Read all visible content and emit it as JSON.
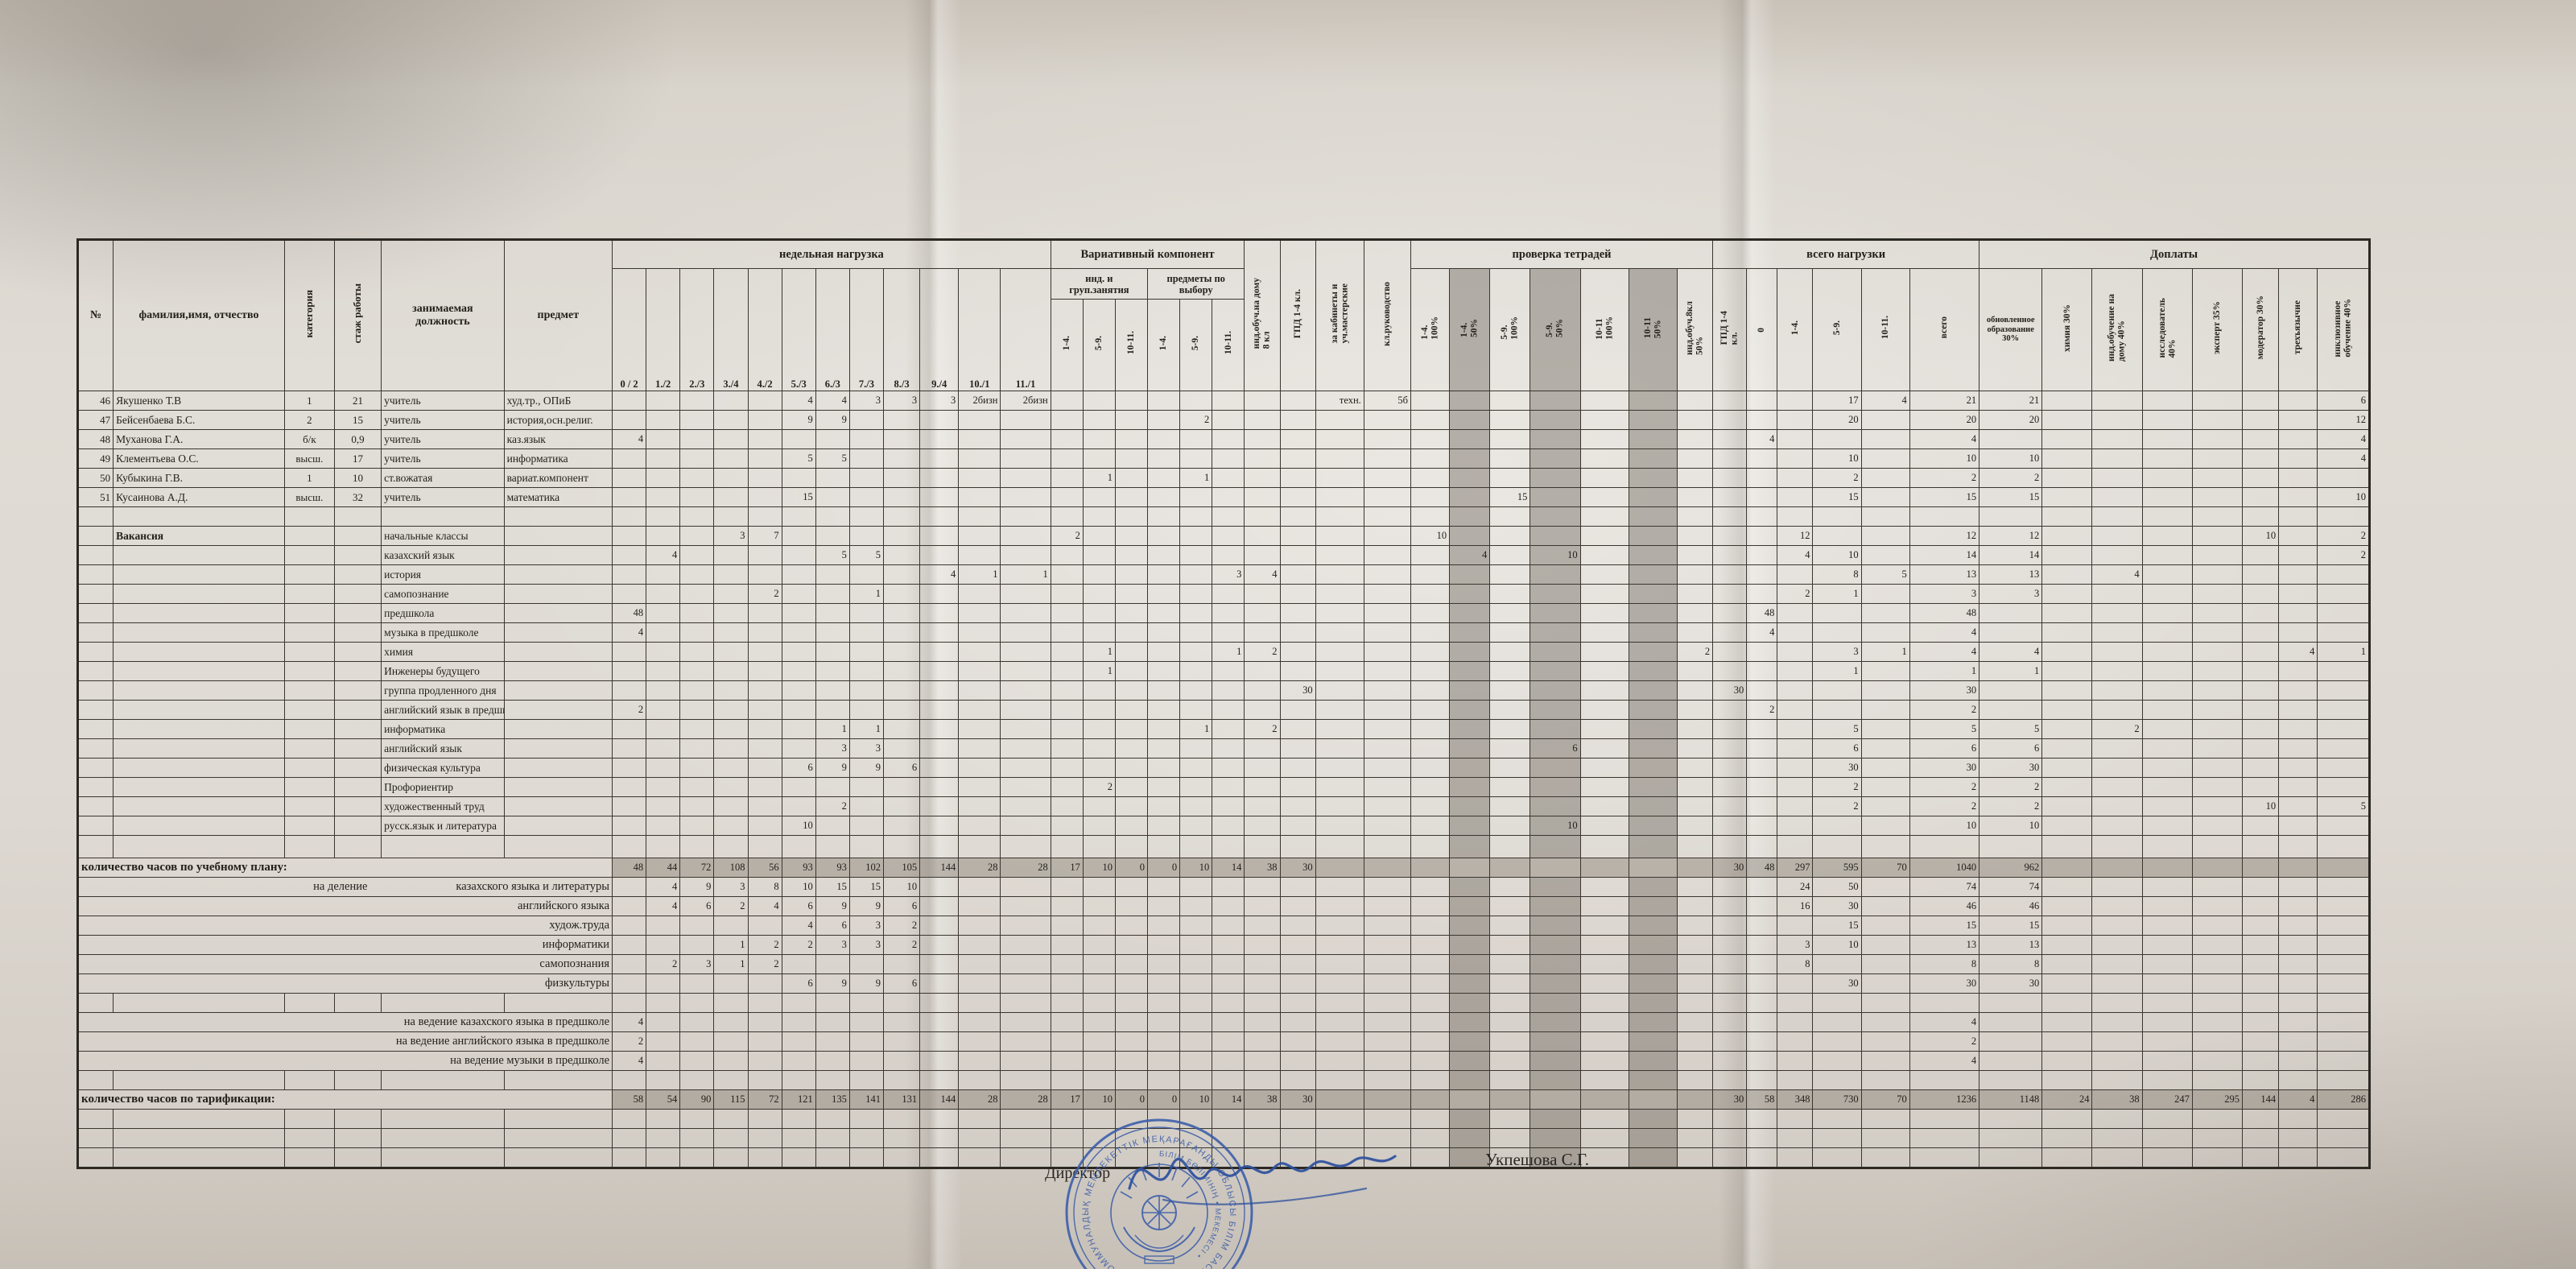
{
  "footer": {
    "director_label": "Директор",
    "director_name": "Укпешова С.Г.",
    "stamp_ring_text": "ҚАРАҒАНДЫ ОБЛЫСЫ БІЛІМ БАСҚАРМАСЫНЫҢ • КОММУНАЛДЫҚ МЕМЛЕКЕТТІК МЕКЕМЕСІ •",
    "stamp_inner_text": "БІЛІМ БӨЛІМІНІҢ • МЕКЕМЕСІ •"
  },
  "table": {
    "base_headers": [
      {
        "label": "№"
      },
      {
        "label": "фамилия,имя, отчество"
      },
      {
        "label": "категория",
        "rotate": true
      },
      {
        "label": "стаж работы",
        "rotate": true
      },
      {
        "label": "занимаемая должность"
      },
      {
        "label": "предмет"
      }
    ],
    "groups": {
      "weekly": "недельная нагрузка",
      "variativ": "Вариативный компонент",
      "notebooks": "проверка тетрадей",
      "load": "всего нагрузки",
      "bonus": "Доплаты"
    },
    "weekly_cols": [
      "0 / 2",
      "1./2",
      "2./3",
      "3./4",
      "4./2",
      "5./3",
      "6./3",
      "7./3",
      "8./3",
      "9./4",
      "10./1",
      "11./1"
    ],
    "variativ_groups": [
      "инд. и\nгруп.занятия",
      "предметы по\nвыбору"
    ],
    "variativ_cols": [
      "1-4.",
      "5-9.",
      "10-11.",
      "1-4.",
      "5-9.",
      "10-11."
    ],
    "single_cols": [
      "инд.обуч.на дому\n8 кл",
      "ГПД    1-4 кл.",
      "за кабинеты и\nуч.мастерские",
      "кл.руководство"
    ],
    "notebook_cols": [
      "1-4.\n100%",
      "1-4.\n50%",
      "5-9.\n100%",
      "5-9.\n50%",
      "10-11\n100%",
      "10-11\n50%",
      "инд.обуч.8кл\n50%"
    ],
    "load_cols": [
      "ГПД 1-4\nкл.",
      "0",
      "1-4.",
      "5-9.",
      "10-11.",
      "всего"
    ],
    "bonus_cols": [
      "обновленное\nобразование\n30%",
      "химия 30%",
      "инд.обучение на\nдому 40%",
      "исследователь\n40%",
      "эксперт 35%",
      "модератор 30%",
      "трехъязычие",
      "инклюзивное\nобучение 40%"
    ],
    "rows": [
      {
        "type": "staff",
        "num": "46",
        "name": "Якушенко Т.В",
        "cat": "1",
        "exp": "21",
        "pos": "учитель",
        "subj": "худ.тр., ОПиБ",
        "cells": {
          "g5": "4",
          "g6": "4",
          "g7": "3",
          "g8": "3",
          "g9": "3",
          "g10": "2бизн",
          "g11": "2бизн",
          "cab": "техн.",
          "lead": "5б",
          "t59": "17",
          "t1011": "4",
          "tot": "21",
          "ren": "21",
          "inc": "6"
        }
      },
      {
        "type": "staff",
        "num": "47",
        "name": "Бейсенбаева Б.С.",
        "cat": "2",
        "exp": "15",
        "pos": "учитель",
        "subj": "история,осн.религ.",
        "cells": {
          "g5": "9",
          "g6": "9",
          "pv59": "2",
          "t59": "20",
          "tot": "20",
          "ren": "20",
          "inc": "12"
        }
      },
      {
        "type": "staff",
        "num": "48",
        "name": "Муханова Г.А.",
        "cat": "б/к",
        "exp": "0,9",
        "pos": "учитель",
        "subj": "каз.язык",
        "cells": {
          "g0": "4",
          "t0": "4",
          "tot": "4",
          "inc": "4"
        }
      },
      {
        "type": "staff",
        "num": "49",
        "name": "Клементьева О.С.",
        "cat": "высш.",
        "exp": "17",
        "pos": "учитель",
        "subj": "информатика",
        "cells": {
          "g5": "5",
          "g6": "5",
          "t59": "10",
          "tot": "10",
          "ren": "10",
          "inc": "4"
        }
      },
      {
        "type": "staff",
        "num": "50",
        "name": "Кубыкина Г.В.",
        "cat": "1",
        "exp": "10",
        "pos": "ст.вожатая",
        "subj": "вариат.компонент",
        "cells": {
          "ig59": "1",
          "pv59": "1",
          "t59": "2",
          "tot": "2",
          "ren": "2"
        }
      },
      {
        "type": "staff",
        "num": "51",
        "name": "Кусаинова А.Д.",
        "cat": "высш.",
        "exp": "32",
        "pos": "учитель",
        "subj": "математика",
        "cells": {
          "g5": "15",
          "n59a": "15",
          "t59": "15",
          "tot": "15",
          "ren": "15",
          "inc": "10"
        }
      },
      {
        "type": "spacer",
        "h": 12
      },
      {
        "type": "vacancy",
        "name": "Вакансия",
        "pos": "начальные классы",
        "cells": {
          "g3": "3",
          "g4": "7",
          "ig14": "2",
          "n14a": "10",
          "t14": "12",
          "tot": "12",
          "ren": "12",
          "mod": "10",
          "inc": "2"
        }
      },
      {
        "type": "vacancy",
        "name": "",
        "pos": "казахский язык",
        "cells": {
          "g1": "4",
          "g6": "5",
          "g7": "5",
          "n14b": "4",
          "n59b": "10",
          "t14": "4",
          "t59": "10",
          "tot": "14",
          "ren": "14",
          "inc": "2"
        }
      },
      {
        "type": "vacancy",
        "name": "",
        "pos": "история",
        "cells": {
          "g9": "4",
          "g10": "1",
          "g11": "1",
          "pv1011": "3",
          "home": "4",
          "t59": "8",
          "t1011": "5",
          "tot": "13",
          "ren": "13",
          "dhome": "4"
        }
      },
      {
        "type": "vacancy",
        "name": "",
        "pos": "самопознание",
        "cells": {
          "g4": "2",
          "g7": "1",
          "t14": "2",
          "t59": "1",
          "tot": "3",
          "ren": "3"
        }
      },
      {
        "type": "vacancy",
        "name": "",
        "pos": "предшкола",
        "cells": {
          "g0": "48",
          "t0": "48",
          "tot": "48"
        }
      },
      {
        "type": "vacancy",
        "name": "",
        "pos": "музыка в предшколе",
        "cells": {
          "g0": "4",
          "t0": "4",
          "tot": "4"
        }
      },
      {
        "type": "vacancy",
        "name": "",
        "pos": "химия",
        "cells": {
          "ig59": "1",
          "pv1011": "1",
          "home": "2",
          "nind": "2",
          "t59": "3",
          "t1011": "1",
          "tot": "4",
          "ren": "4",
          "tri": "4",
          "inc": "1"
        }
      },
      {
        "type": "vacancy",
        "name": "",
        "pos": "Инженеры будущего",
        "cells": {
          "ig59": "1",
          "t59": "1",
          "tot": "1",
          "ren": "1"
        }
      },
      {
        "type": "vacancy",
        "name": "",
        "pos": "группа продленного дня",
        "cells": {
          "gpd": "30",
          "tgpd": "30",
          "tot": "30"
        }
      },
      {
        "type": "vacancy",
        "name": "",
        "pos": "английский язык в предшколе",
        "cells": {
          "g0": "2",
          "t0": "2",
          "tot": "2"
        }
      },
      {
        "type": "vacancy",
        "name": "",
        "pos": "информатика",
        "cells": {
          "g6": "1",
          "g7": "1",
          "pv59": "1",
          "home": "2",
          "t59": "5",
          "tot": "5",
          "ren": "5",
          "dhome": "2"
        }
      },
      {
        "type": "vacancy",
        "name": "",
        "pos": "английский язык",
        "cells": {
          "g6": "3",
          "g7": "3",
          "n59b": "6",
          "t59": "6",
          "tot": "6",
          "ren": "6"
        }
      },
      {
        "type": "vacancy",
        "name": "",
        "pos": "физическая культура",
        "cells": {
          "g5": "6",
          "g6": "9",
          "g7": "9",
          "g8": "6",
          "t59": "30",
          "tot": "30",
          "ren": "30"
        }
      },
      {
        "type": "vacancy",
        "name": "",
        "pos": "Профориентир",
        "cells": {
          "ig59": "2",
          "t59": "2",
          "tot": "2",
          "ren": "2"
        }
      },
      {
        "type": "vacancy",
        "name": "",
        "pos": "художественный труд",
        "cells": {
          "g6": "2",
          "t59": "2",
          "tot": "2",
          "ren": "2",
          "mod": "10",
          "inc": "5"
        }
      },
      {
        "type": "vacancy",
        "name": "",
        "pos": "русск.язык и литература",
        "cells": {
          "g5": "10",
          "n59b": "10",
          "tot": "10",
          "ren": "10"
        }
      },
      {
        "type": "spacer",
        "h": 28
      },
      {
        "type": "total",
        "label": "количество часов по учебному плану:",
        "shaded": true,
        "cells": {
          "g0": "48",
          "g1": "44",
          "g2": "72",
          "g3": "108",
          "g4": "56",
          "g5": "93",
          "g6": "93",
          "g7": "102",
          "g8": "105",
          "g9": "144",
          "g10": "28",
          "g11": "28",
          "ig14": "17",
          "ig59": "10",
          "ig1011": "0",
          "pv14": "0",
          "pv59": "10",
          "pv1011": "14",
          "home": "38",
          "gpd": "30",
          "tgpd": "30",
          "t0": "48",
          "t14": "297",
          "t59": "595",
          "t1011": "70",
          "tot": "1040",
          "ren": "962"
        }
      },
      {
        "type": "sub",
        "prefix": "на деление",
        "label": "казахского языка и литературы",
        "cells": {
          "g1": "4",
          "g2": "9",
          "g3": "3",
          "g4": "8",
          "g5": "10",
          "g6": "15",
          "g7": "15",
          "g8": "10",
          "t14": "24",
          "t59": "50",
          "tot": "74",
          "ren": "74"
        }
      },
      {
        "type": "sub",
        "prefix": "",
        "label": "английского языка",
        "cells": {
          "g1": "4",
          "g2": "6",
          "g3": "2",
          "g4": "4",
          "g5": "6",
          "g6": "9",
          "g7": "9",
          "g8": "6",
          "t14": "16",
          "t59": "30",
          "tot": "46",
          "ren": "46"
        }
      },
      {
        "type": "sub",
        "prefix": "",
        "label": "худож.труда",
        "cells": {
          "g5": "4",
          "g6": "6",
          "g7": "3",
          "g8": "2",
          "t59": "15",
          "tot": "15",
          "ren": "15"
        }
      },
      {
        "type": "sub",
        "prefix": "",
        "label": "информатики",
        "cells": {
          "g3": "1",
          "g4": "2",
          "g5": "2",
          "g6": "3",
          "g7": "3",
          "g8": "2",
          "t14": "3",
          "t59": "10",
          "tot": "13",
          "ren": "13"
        }
      },
      {
        "type": "sub",
        "prefix": "",
        "label": "самопознания",
        "cells": {
          "g1": "2",
          "g2": "3",
          "g3": "1",
          "g4": "2",
          "t14": "8",
          "tot": "8",
          "ren": "8"
        }
      },
      {
        "type": "sub",
        "prefix": "",
        "label": "физкультуры",
        "cells": {
          "g5": "6",
          "g6": "9",
          "g7": "9",
          "g8": "6",
          "t59": "30",
          "tot": "30",
          "ren": "30"
        }
      },
      {
        "type": "spacer",
        "h": 16
      },
      {
        "type": "sub",
        "prefix": "",
        "label": "на ведение казахского языка в предшколе",
        "cells": {
          "g0": "4",
          "tot": "4"
        }
      },
      {
        "type": "sub",
        "prefix": "",
        "label": "на ведение английского языка в предшколе",
        "cells": {
          "g0": "2",
          "tot": "2"
        }
      },
      {
        "type": "sub",
        "prefix": "",
        "label": "на ведение музыки в предшколе",
        "cells": {
          "g0": "4",
          "tot": "4"
        }
      },
      {
        "type": "spacer",
        "h": 16
      },
      {
        "type": "total",
        "label": "количество часов по тарификации:",
        "shaded": true,
        "cells": {
          "g0": "58",
          "g1": "54",
          "g2": "90",
          "g3": "115",
          "g4": "72",
          "g5": "121",
          "g6": "135",
          "g7": "141",
          "g8": "131",
          "g9": "144",
          "g10": "28",
          "g11": "28",
          "ig14": "17",
          "ig59": "10",
          "ig1011": "0",
          "pv14": "0",
          "pv59": "10",
          "pv1011": "14",
          "home": "38",
          "gpd": "30",
          "tgpd": "30",
          "t0": "58",
          "t14": "348",
          "t59": "730",
          "t1011": "70",
          "tot": "1236",
          "ren": "1148",
          "chem": "24",
          "dhome": "38",
          "res": "247",
          "exp35": "295",
          "mod": "144",
          "tri": "4",
          "inc": "286"
        }
      },
      {
        "type": "spacer",
        "h": 23
      },
      {
        "type": "spacer",
        "h": 23
      },
      {
        "type": "spacer",
        "h": 23
      }
    ]
  }
}
